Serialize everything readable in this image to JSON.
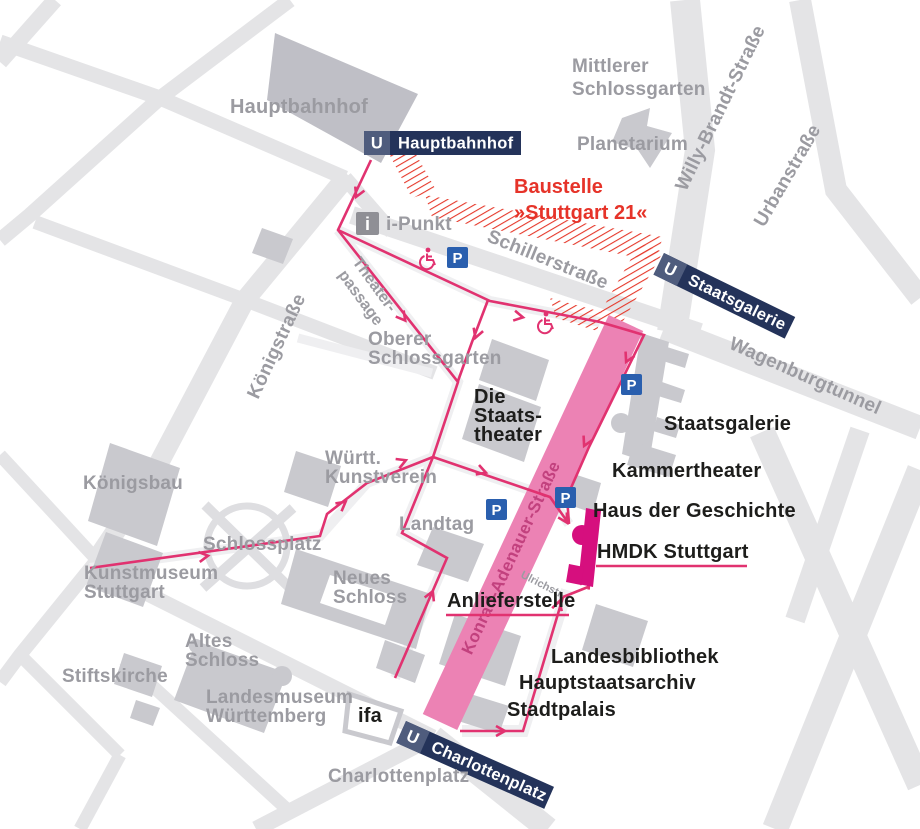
{
  "colors": {
    "route_pink": "#e13270",
    "band_pink": "#ec82b4",
    "band_text_pink": "#c2417e",
    "hmdk_magenta": "#d60f7e",
    "badge_navy": "#24335a",
    "badge_u_box": "#4f5c7d",
    "construction_red": "#e6332b",
    "parking_blue": "#2a5fae",
    "street_gray": "#e4e4e6",
    "building_gray": "#c9c9ce",
    "label_gray": "#9b9ba1"
  },
  "stations": {
    "u_symbol": "U",
    "hauptbahnhof": "Hauptbahnhof",
    "staatsgalerie": "Staatsgalerie",
    "charlottenplatz": "Charlottenplatz"
  },
  "construction": {
    "line1": "Baustelle",
    "line2": "»Stuttgart 21«"
  },
  "destination": {
    "hmdk": "HMDK Stuttgart",
    "anlieferstelle": "Anlieferstelle"
  },
  "streets": {
    "koenigstrasse": "Königstraße",
    "schillerstrasse": "Schillerstraße",
    "willy_brandt": "Willy-Brandt-Straße",
    "urbanstrasse": "Urbanstraße",
    "wagenburgtunnel": "Wagenburgtunnel",
    "konrad_adenauer": "Konrad-Adenauer-Straße",
    "theaterpassage_line1": "Theater-",
    "theaterpassage_line2": "passage",
    "ulrichstrasse": "Ulrichstr."
  },
  "places": {
    "hauptbahnhof": "Hauptbahnhof",
    "mittlerer_schlossgarten_1": "Mittlerer",
    "mittlerer_schlossgarten_2": "Schlossgarten",
    "planetarium": "Planetarium",
    "oberer_schlossgarten_1": "Oberer",
    "oberer_schlossgarten_2": "Schlossgarten",
    "koenigsbau": "Königsbau",
    "kunstmuseum_1": "Kunstmuseum",
    "kunstmuseum_2": "Stuttgart",
    "schlossplatz": "Schlossplatz",
    "wuertt_kunstverein_1": "Württ.",
    "wuertt_kunstverein_2": "Kunstverein",
    "landtag": "Landtag",
    "neues_schloss_1": "Neues",
    "neues_schloss_2": "Schloss",
    "altes_schloss_1": "Altes",
    "altes_schloss_2": "Schloss",
    "stiftskirche": "Stiftskirche",
    "landesmuseum_1": "Landesmuseum",
    "landesmuseum_2": "Württemberg",
    "charlottenplatz_area": "Charlottenplatz"
  },
  "landmarks": {
    "die_staatstheater_1": "Die",
    "die_staatstheater_2": "Staats-",
    "die_staatstheater_3": "theater",
    "staatsgalerie": "Staatsgalerie",
    "kammertheater": "Kammertheater",
    "haus_der_geschichte": "Haus der Geschichte",
    "landesbibliothek": "Landesbibliothek",
    "hauptstaatsarchiv": "Hauptstaatsarchiv",
    "stadtpalais": "Stadtpalais",
    "ifa": "ifa"
  },
  "icons": {
    "parking": "P",
    "info": "i",
    "info_label": "i-Punkt",
    "wheelchair_name": "wheelchair-accessible"
  }
}
